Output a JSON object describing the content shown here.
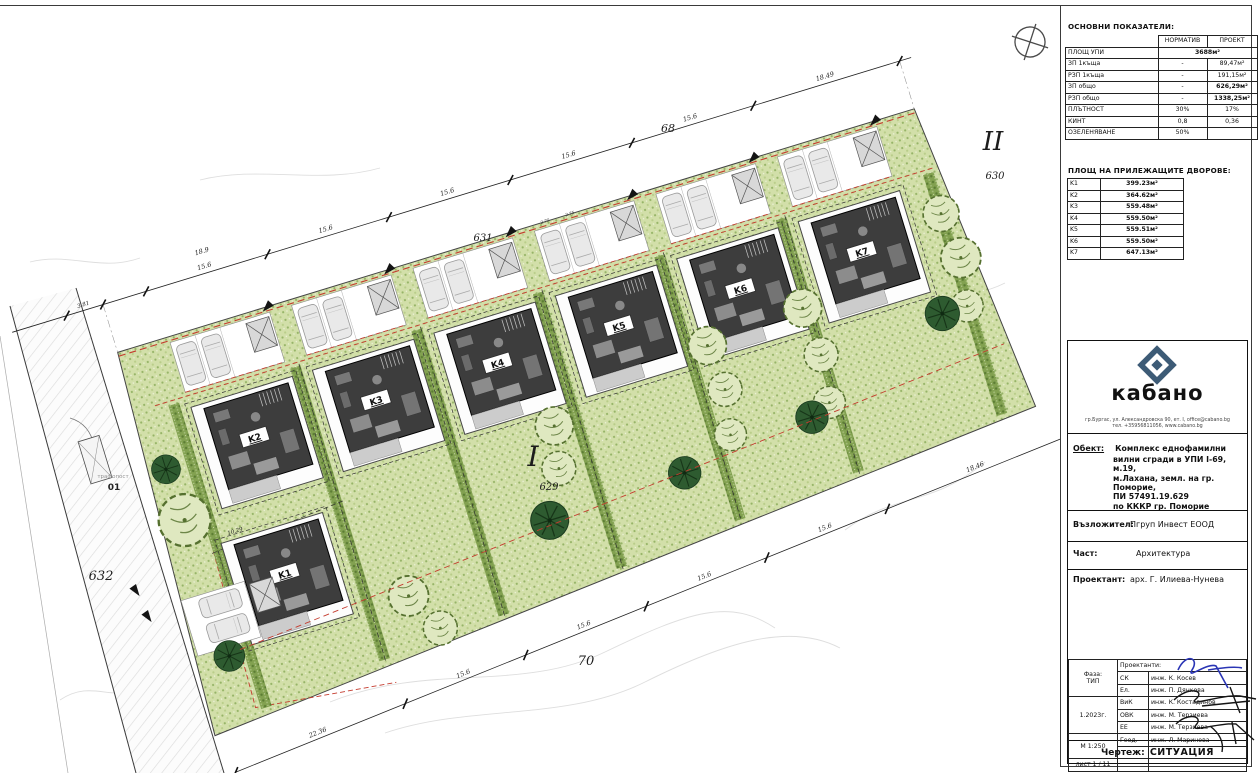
{
  "plan": {
    "houses": [
      "K1",
      "K2",
      "K3",
      "K4",
      "K5",
      "K6",
      "K7"
    ],
    "parcels": {
      "p68": "68",
      "p631": "631",
      "p630": "630",
      "p629": "629",
      "p632": "632",
      "p70": "70"
    },
    "zones": {
      "z1": "I",
      "z2": "II"
    },
    "transformer": {
      "label": "трафопост",
      "number": "01"
    },
    "red_line_label": "огр. линия на застр.",
    "dim_top": [
      "3.81",
      "18.9",
      "15.6",
      "15.6",
      "15.6",
      "15.6",
      "15.6",
      "18.49"
    ],
    "dim_bottom": [
      "22.36",
      "15.6",
      "15.6",
      "15.6",
      "15.6",
      "18.46"
    ],
    "dim_k1_front": "10.29",
    "dim_stall": "2.75",
    "north_icon": "north-arrow"
  },
  "titleblock": {
    "indicators": {
      "title": "ОСНОВНИ ПОКАЗАТЕЛИ:",
      "col_norm": "НОРМАТИВ",
      "col_proj": "ПРОЕКТ",
      "upi_label": "ПЛОЩ УПИ",
      "upi_value": "3688м²",
      "rows": [
        {
          "label": "ЗП 1къща",
          "norm": "-",
          "proj": "89,47м²"
        },
        {
          "label": "РЗП 1къща",
          "norm": "-",
          "proj": "191,15м²"
        },
        {
          "label": "ЗП общо",
          "norm": "-",
          "proj": "626,29м²"
        },
        {
          "label": "РЗП общо",
          "norm": "-",
          "proj": "1338,25м²"
        },
        {
          "label": "ПЛЪТНОСТ",
          "norm": "30%",
          "proj": "17%"
        },
        {
          "label": "КИНТ",
          "norm": "0,8",
          "proj": "0,36"
        },
        {
          "label": "ОЗЕЛЕНЯВАНЕ",
          "norm": "50%",
          "proj": ""
        }
      ]
    },
    "yards": {
      "title": "ПЛОЩ НА ПРИЛЕЖАЩИТЕ ДВОРОВЕ:",
      "rows": [
        {
          "k": "K1",
          "v": "399.23м²"
        },
        {
          "k": "K2",
          "v": "364.62м²"
        },
        {
          "k": "K3",
          "v": "559.48м²"
        },
        {
          "k": "K4",
          "v": "559.50м²"
        },
        {
          "k": "K5",
          "v": "559.51м²"
        },
        {
          "k": "K6",
          "v": "559.50м²"
        },
        {
          "k": "K7",
          "v": "647.13м²"
        }
      ]
    },
    "logo": {
      "name": "кабано",
      "address1": "гр.Бургас, ул. Александровска 90, ет. I, office@cabano.bg",
      "address2": "тел. +35956811056, www.cabano.bg"
    },
    "object": {
      "label": "Обект:",
      "lines": [
        "Комплекс еднофамилни",
        "вилни сгради в УПИ I-69, м.19,",
        "м.Лахана, земл. на гр. Поморие,",
        "ПИ 57491.19.629",
        "по КККР гр. Поморие"
      ]
    },
    "client": {
      "label": "Възложител:",
      "value": "Пгруп Инвест ЕООД"
    },
    "part": {
      "label": "Част:",
      "value": "Архитектура"
    },
    "designer": {
      "label": "Проектант:",
      "value": "арх. Г. Илиева-Нунева"
    },
    "phase": {
      "label": "Фаза:",
      "value": "ТИП"
    },
    "date": "1.2023г.",
    "scale": "М 1:250",
    "sheet": "лист  1 / 11",
    "team_header": "Проектанти:",
    "team": [
      {
        "code": "СК",
        "name": "инж. К. Косев"
      },
      {
        "code": "Ел.",
        "name": "инж. П. Дянкова"
      },
      {
        "code": "ВиК",
        "name": "инж. К. Костадинов"
      },
      {
        "code": "ОВК",
        "name": "инж. М. Терзиева"
      },
      {
        "code": "ЕЕ",
        "name": "инж. М. Терзиева"
      },
      {
        "code": "Геод.",
        "name": "инж. Л. Маринова"
      }
    ],
    "drawing": {
      "label": "Чертеж:",
      "value": "СИТУАЦИЯ"
    }
  }
}
